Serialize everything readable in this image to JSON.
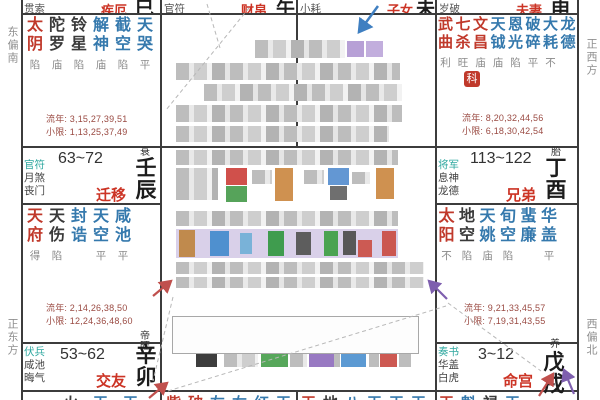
{
  "palette": {
    "pname": "#cc3425",
    "major": "#c0392b",
    "malefic": "#3a3a3a",
    "minor": "#3579ad",
    "teal": "#2fa8a0",
    "bright": "#8a8a8a",
    "maroon": "#9a4a42",
    "branch": "#1c1c1c",
    "grid": "#3c3c3c",
    "sidebar": "#8f8f8f",
    "arrow_blue": "#3f7fc1",
    "arrow_red": "#c0504d",
    "arrow_purple": "#7e5fae",
    "dash": "#b8b8b8"
  },
  "sidebar": {
    "left_top": "东偏南",
    "left_bottom": "正东方",
    "right_top": "正西方",
    "right_bottom": "西偏北"
  },
  "top_row": {
    "si": {
      "shensha": "贯索",
      "palace": "疾厄",
      "branch": "巳"
    },
    "wu": {
      "shensha": "官符",
      "palace": "财帛",
      "branch": "午"
    },
    "wei": {
      "shensha": "小耗",
      "palace": "子女",
      "branch": "未"
    },
    "shen": {
      "shensha": "岁破",
      "palace": "夫妻",
      "branch": "申"
    }
  },
  "si_cell": {
    "stars": [
      {
        "n": "太阴",
        "b": "陷",
        "t": "M"
      },
      {
        "n": "陀罗",
        "b": "庙",
        "t": "K"
      },
      {
        "n": "铃星",
        "b": "陷",
        "t": "K"
      },
      {
        "n": "解神",
        "b": "庙",
        "t": "A"
      },
      {
        "n": "截空",
        "b": "陷",
        "t": "A"
      },
      {
        "n": "天哭",
        "b": "平",
        "t": "A"
      }
    ],
    "liunian": "流年: 3,15,27,39,51",
    "xiaoxian": "小限: 1,13,25,37,49"
  },
  "shen_cell": {
    "stars": [
      {
        "n": "武曲",
        "b": "利",
        "t": "M"
      },
      {
        "n": "七杀",
        "b": "旺",
        "t": "M"
      },
      {
        "n": "文昌",
        "b": "庙",
        "t": "M"
      },
      {
        "n": "天钺",
        "b": "庙",
        "t": "A"
      },
      {
        "n": "恩光",
        "b": "陷",
        "t": "A"
      },
      {
        "n": "破碎",
        "b": "平",
        "t": "A"
      },
      {
        "n": "大耗",
        "b": "不",
        "t": "A"
      },
      {
        "n": "龙德",
        "b": "",
        "t": "A"
      }
    ],
    "sihua": "科",
    "liunian": "流年: 8,20,32,44,56",
    "xiaoxian": "小限: 6,18,30,42,54"
  },
  "chen_cell": {
    "strip": {
      "shensha": "官符\n月煞\n丧门",
      "range": "63~72",
      "palace": "迁移",
      "stage": "衰",
      "ganzhi": "壬辰"
    },
    "stars": [
      {
        "n": "天府",
        "b": "得",
        "t": "M"
      },
      {
        "n": "天伤",
        "b": "陷",
        "t": "K"
      },
      {
        "n": "封诰",
        "b": "",
        "t": "A"
      },
      {
        "n": "天空",
        "b": "平",
        "t": "A"
      },
      {
        "n": "咸池",
        "b": "平",
        "t": "A"
      }
    ],
    "liunian": "流年: 2,14,26,38,50",
    "xiaoxian": "小限: 12,24,36,48,60"
  },
  "you_cell": {
    "strip": {
      "shensha": "将军\n息神\n龙德",
      "range": "113~122",
      "palace": "兄弟",
      "stage": "胎",
      "ganzhi": "丁酉"
    },
    "stars": [
      {
        "n": "太阳",
        "b": "不",
        "t": "M"
      },
      {
        "n": "地空",
        "b": "陷",
        "t": "K"
      },
      {
        "n": "天姚",
        "b": "庙",
        "t": "A"
      },
      {
        "n": "旬空",
        "b": "陷",
        "t": "A"
      },
      {
        "n": "蜚廉",
        "b": "",
        "t": "A"
      },
      {
        "n": "华盖",
        "b": "平",
        "t": "A"
      }
    ],
    "liunian": "流年: 9,21,33,45,57",
    "xiaoxian": "小限: 7,19,31,43,55"
  },
  "mao_cell": {
    "strip": {
      "shensha": "伏兵\n咸池\n晦气",
      "range": "53~62",
      "palace": "交友",
      "stage": "帝旺",
      "ganzhi": "辛卯"
    },
    "partial_stars": [
      {
        "n": "火",
        "t": "K"
      },
      {
        "n": "天",
        "t": "A"
      },
      {
        "n": "天",
        "t": "A"
      }
    ]
  },
  "xu_cell": {
    "strip": {
      "shensha": "奏书\n华盖\n白虎",
      "range": "3~12",
      "palace": "命宫",
      "stage": "养",
      "ganzhi": "戊戌"
    },
    "partial_stars": [
      {
        "n": "天",
        "t": "M"
      },
      {
        "n": "魁",
        "t": "A"
      },
      {
        "n": "禄",
        "t": "K"
      },
      {
        "n": "天",
        "t": "A"
      }
    ]
  },
  "bottom_partials": {
    "chou": [
      {
        "n": "紫",
        "t": "M"
      },
      {
        "n": "破",
        "t": "M"
      },
      {
        "n": "左",
        "t": "A"
      },
      {
        "n": "右",
        "t": "A"
      },
      {
        "n": "红",
        "t": "A"
      },
      {
        "n": "天",
        "t": "A"
      }
    ],
    "zi": [
      {
        "n": "天",
        "t": "M"
      },
      {
        "n": "地",
        "t": "K"
      },
      {
        "n": "八",
        "t": "A"
      },
      {
        "n": "天",
        "t": "A"
      },
      {
        "n": "天",
        "t": "A"
      },
      {
        "n": "天",
        "t": "A"
      }
    ]
  },
  "center": {
    "mosaic": {
      "gray": [
        [
          255,
          40,
          90,
          18
        ],
        [
          176,
          63,
          224,
          17
        ],
        [
          204,
          84,
          198,
          17
        ],
        [
          176,
          105,
          226,
          17
        ],
        [
          176,
          126,
          213,
          16
        ],
        [
          176,
          150,
          222,
          15
        ],
        [
          176,
          168,
          42,
          32
        ],
        [
          252,
          170,
          20,
          14
        ],
        [
          304,
          170,
          20,
          14
        ],
        [
          352,
          172,
          18,
          12
        ],
        [
          176,
          211,
          222,
          15
        ],
        [
          176,
          262,
          248,
          12
        ],
        [
          176,
          277,
          248,
          11
        ],
        [
          180,
          320,
          228,
          11
        ],
        [
          180,
          333,
          150,
          10
        ],
        [
          224,
          352,
          34,
          15
        ],
        [
          290,
          353,
          17,
          14
        ],
        [
          333,
          353,
          7,
          14
        ],
        [
          369,
          353,
          10,
          14
        ],
        [
          399,
          353,
          12,
          14
        ]
      ],
      "colored": [
        [
          347,
          41,
          17,
          16,
          "#b7a0d6"
        ],
        [
          366,
          41,
          17,
          16,
          "#c2aedd"
        ],
        [
          226,
          168,
          21,
          17,
          "#d0504b"
        ],
        [
          226,
          186,
          21,
          16,
          "#56a35a"
        ],
        [
          275,
          168,
          18,
          33,
          "#cf9150"
        ],
        [
          328,
          168,
          21,
          17,
          "#6397d3"
        ],
        [
          330,
          186,
          17,
          14,
          "#6f6f6f"
        ],
        [
          376,
          168,
          18,
          31,
          "#cf9150"
        ],
        [
          176,
          229,
          222,
          29,
          "#d9d0e9"
        ],
        [
          179,
          230,
          16,
          27,
          "#c08a4d"
        ],
        [
          210,
          231,
          19,
          25,
          "#4f90cf"
        ],
        [
          240,
          233,
          12,
          21,
          "#79b2d8"
        ],
        [
          268,
          231,
          16,
          25,
          "#3f9c4e"
        ],
        [
          296,
          232,
          15,
          23,
          "#5d5d5d"
        ],
        [
          324,
          231,
          14,
          25,
          "#4aa351"
        ],
        [
          343,
          231,
          13,
          24,
          "#585858"
        ],
        [
          358,
          240,
          14,
          17,
          "#cc5a53"
        ],
        [
          382,
          231,
          14,
          25,
          "#cb5750"
        ],
        [
          196,
          347,
          21,
          20,
          "#3d3d3d"
        ],
        [
          261,
          352,
          27,
          15,
          "#57a75b"
        ],
        [
          309,
          352,
          25,
          15,
          "#9879c2"
        ],
        [
          341,
          352,
          25,
          15,
          "#5c9ad3"
        ],
        [
          380,
          352,
          17,
          15,
          "#cd5952"
        ]
      ]
    }
  }
}
